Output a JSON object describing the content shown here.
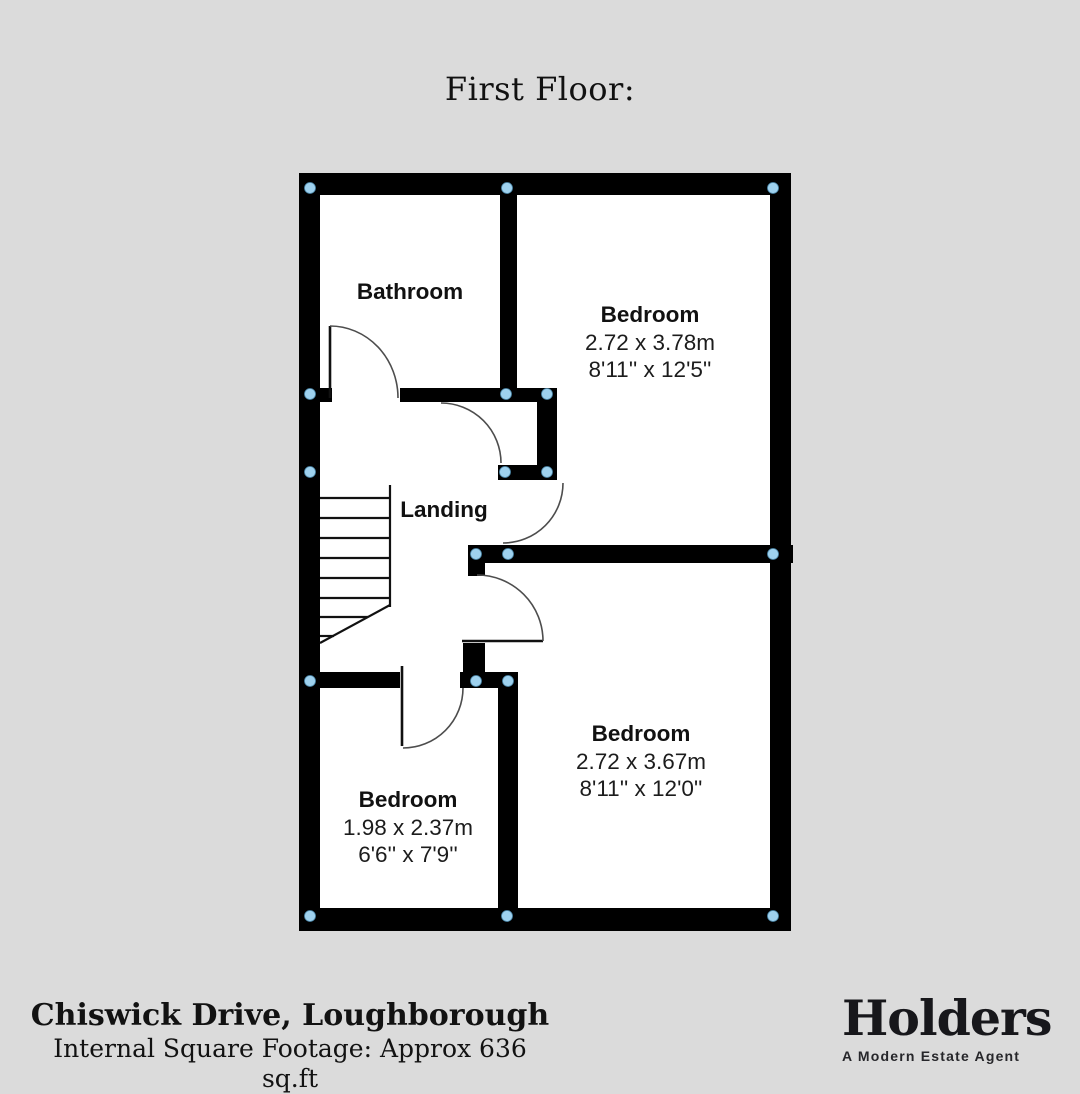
{
  "page": {
    "background": "#dbdbdb",
    "title": "First Floor:"
  },
  "footer": {
    "address": "Chiswick Drive, Loughborough",
    "footage": "Internal Square Footage: Approx 636 sq.ft"
  },
  "logo": {
    "wordmark": "Holders",
    "tagline": "A Modern Estate Agent"
  },
  "floorplan": {
    "colors": {
      "wall": "#000000",
      "floor": "#ffffff",
      "junction_dot": "#9ed1ee",
      "junction_dot_edge": "#4d89ab",
      "door_arc": "#4d4d4d",
      "door_leaf": "#111111",
      "stair_line": "#111111",
      "label": "#111111",
      "dims": "#1c1c1c"
    },
    "floor_rect": [
      299,
      173,
      492,
      757
    ],
    "walls": [
      [
        299,
        173,
        492,
        22
      ],
      [
        299,
        908,
        492,
        23
      ],
      [
        299,
        173,
        21,
        757
      ],
      [
        770,
        173,
        21,
        757
      ],
      [
        500,
        195,
        17,
        207
      ],
      [
        299,
        388,
        33,
        14
      ],
      [
        400,
        388,
        153,
        14
      ],
      [
        537,
        388,
        20,
        92
      ],
      [
        498,
        465,
        59,
        15
      ],
      [
        468,
        545,
        325,
        18
      ],
      [
        468,
        563,
        17,
        13
      ],
      [
        463,
        643,
        22,
        45
      ],
      [
        460,
        672,
        58,
        16
      ],
      [
        299,
        672,
        101,
        16
      ],
      [
        498,
        672,
        20,
        238
      ]
    ],
    "stairs": {
      "lines": [
        [
          390,
          485,
          390,
          607
        ],
        [
          320,
          498,
          390,
          498
        ],
        [
          320,
          518,
          390,
          518
        ],
        [
          320,
          538,
          390,
          538
        ],
        [
          320,
          558,
          390,
          558
        ],
        [
          320,
          578,
          390,
          578
        ],
        [
          320,
          598,
          390,
          598
        ],
        [
          320,
          617,
          368,
          617
        ],
        [
          320,
          636,
          334,
          636
        ],
        [
          390,
          605,
          320,
          643
        ]
      ]
    },
    "doors": [
      {
        "name": "bathroom-door",
        "leaf": [
          330,
          326,
          330,
          398
        ],
        "arc": "M 330 326 A 68 72 0 0 1 398 398"
      },
      {
        "name": "cupboard-door",
        "leaf": null,
        "arc": "M 441 403 A 60 60 0 0 1 501 463"
      },
      {
        "name": "bedroom-1-door",
        "leaf": null,
        "arc": "M 563 483 A 60 60 0 0 1 503 543"
      },
      {
        "name": "bedroom-2-door",
        "leaf": [
          462,
          641,
          543,
          641
        ],
        "arc": "M 477 575 A 66 66 0 0 1 543 641"
      },
      {
        "name": "bedroom-3-door",
        "leaf": [
          402,
          666,
          402,
          746
        ],
        "arc": "M 463 688 A 60 60 0 0 1 403 748"
      }
    ],
    "junction_dots": [
      [
        310,
        188
      ],
      [
        507,
        188
      ],
      [
        773,
        188
      ],
      [
        310,
        394
      ],
      [
        506,
        394
      ],
      [
        547,
        394
      ],
      [
        310,
        472
      ],
      [
        505,
        472
      ],
      [
        547,
        472
      ],
      [
        476,
        554
      ],
      [
        508,
        554
      ],
      [
        773,
        554
      ],
      [
        310,
        681
      ],
      [
        476,
        681
      ],
      [
        508,
        681
      ],
      [
        310,
        916
      ],
      [
        507,
        916
      ],
      [
        773,
        916
      ]
    ],
    "rooms": [
      {
        "id": "bathroom",
        "label": "Bathroom",
        "cx": 410,
        "cy": 299,
        "metric": "",
        "imperial": ""
      },
      {
        "id": "bedroom-1",
        "label": "Bedroom",
        "cx": 650,
        "cy": 322,
        "metric": "2.72 x 3.78m",
        "imperial": "8'11'' x 12'5''"
      },
      {
        "id": "landing",
        "label": "Landing",
        "cx": 444,
        "cy": 517,
        "metric": "",
        "imperial": ""
      },
      {
        "id": "bedroom-2",
        "label": "Bedroom",
        "cx": 641,
        "cy": 741,
        "metric": "2.72 x 3.67m",
        "imperial": "8'11'' x 12'0''"
      },
      {
        "id": "bedroom-3",
        "label": "Bedroom",
        "cx": 408,
        "cy": 807,
        "metric": "1.98 x 2.37m",
        "imperial": "6'6'' x 7'9''"
      }
    ]
  }
}
